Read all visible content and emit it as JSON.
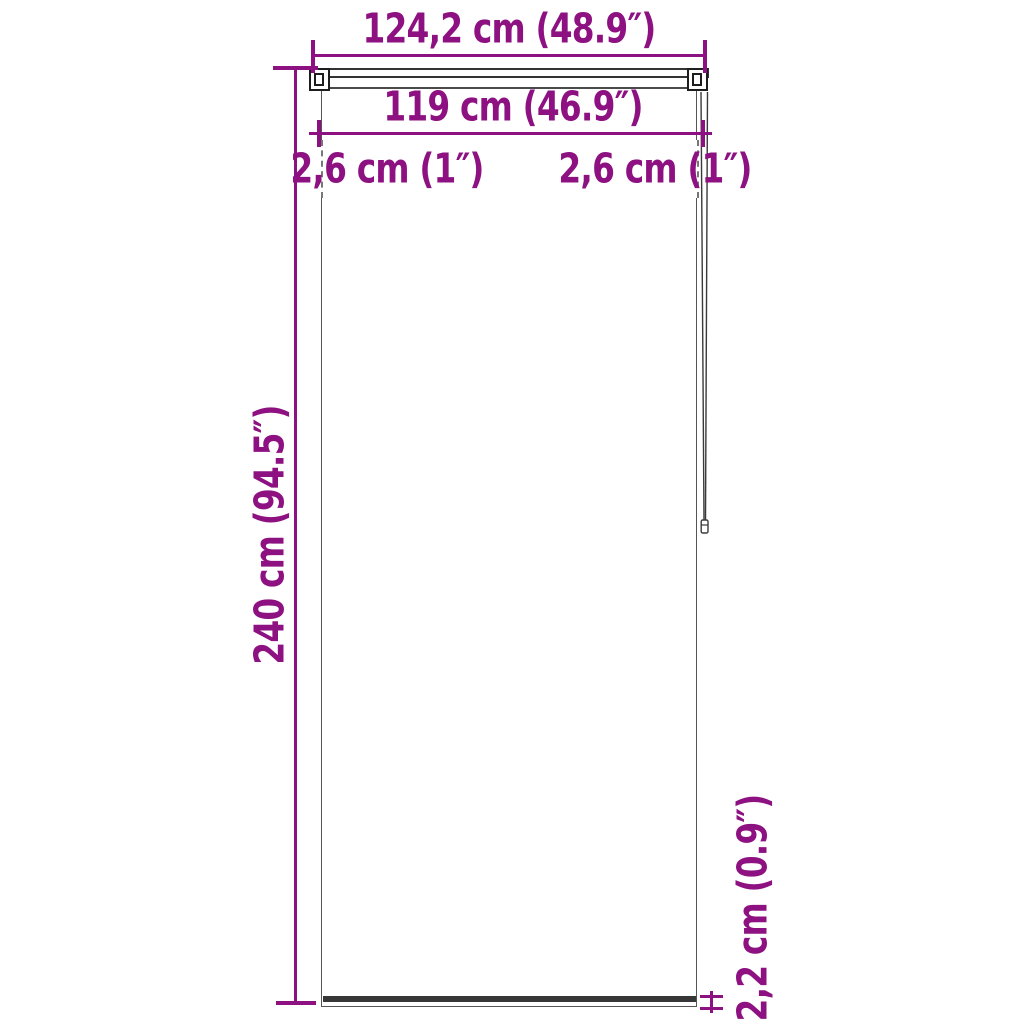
{
  "diagram": {
    "accent_color": "#8e1182",
    "line_color": "#3a3a3a",
    "labels": {
      "outer_width": "124,2 cm (48.9″)",
      "inner_width": "119 cm (46.9″)",
      "left_bracket_offset": "2,6 cm (1″)",
      "right_bracket_offset": "2,6 cm (1″)",
      "drop_height": "240 cm (94.5″)",
      "bottom_bar_height": "2,2 cm (0.9″)"
    }
  }
}
